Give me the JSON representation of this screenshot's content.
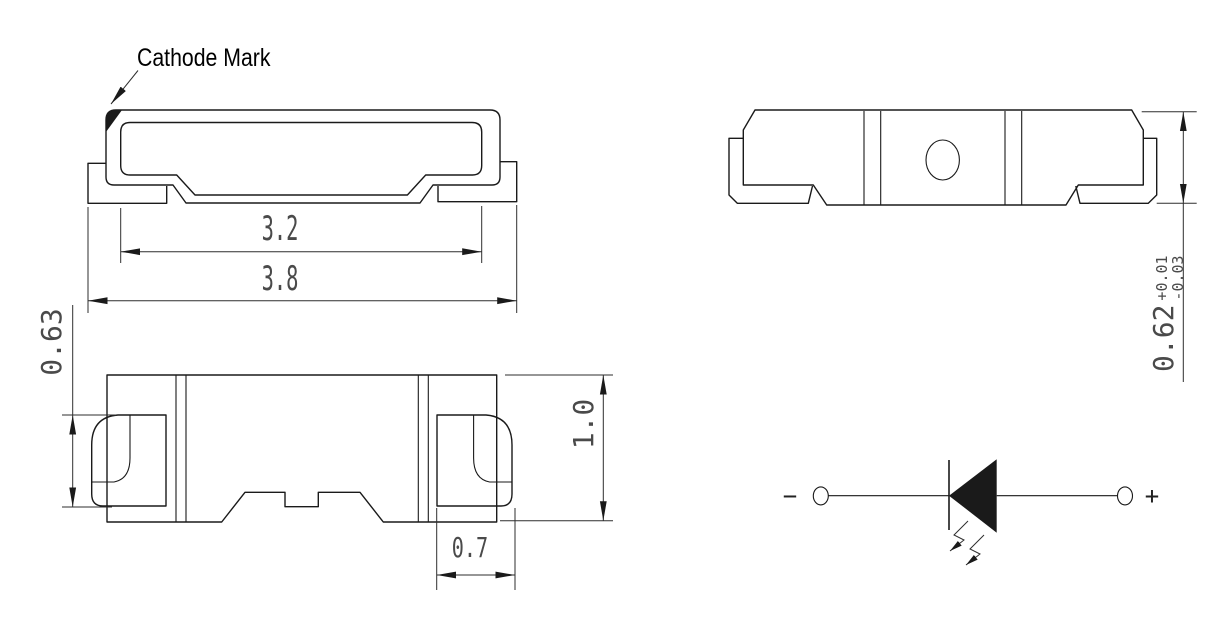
{
  "labels": {
    "cathode_mark": "Cathode Mark"
  },
  "dimensions": {
    "top_view": {
      "inner_width": "3.2",
      "overall_width": "3.8"
    },
    "front_view": {
      "lead_height": "0.63",
      "body_height": "1.0",
      "lead_width": "0.7"
    },
    "side_view": {
      "thickness": "0.62",
      "tolerance_plus": "+0.01",
      "tolerance_minus": "-0.03"
    }
  },
  "schematic": {
    "minus_label": "−",
    "plus_label": "+"
  },
  "colors": {
    "outline": "#1a1a1a",
    "dimension": "#2e2e2e",
    "dim_text": "#4a4a4a",
    "label_text": "#000000",
    "background": "#ffffff"
  }
}
